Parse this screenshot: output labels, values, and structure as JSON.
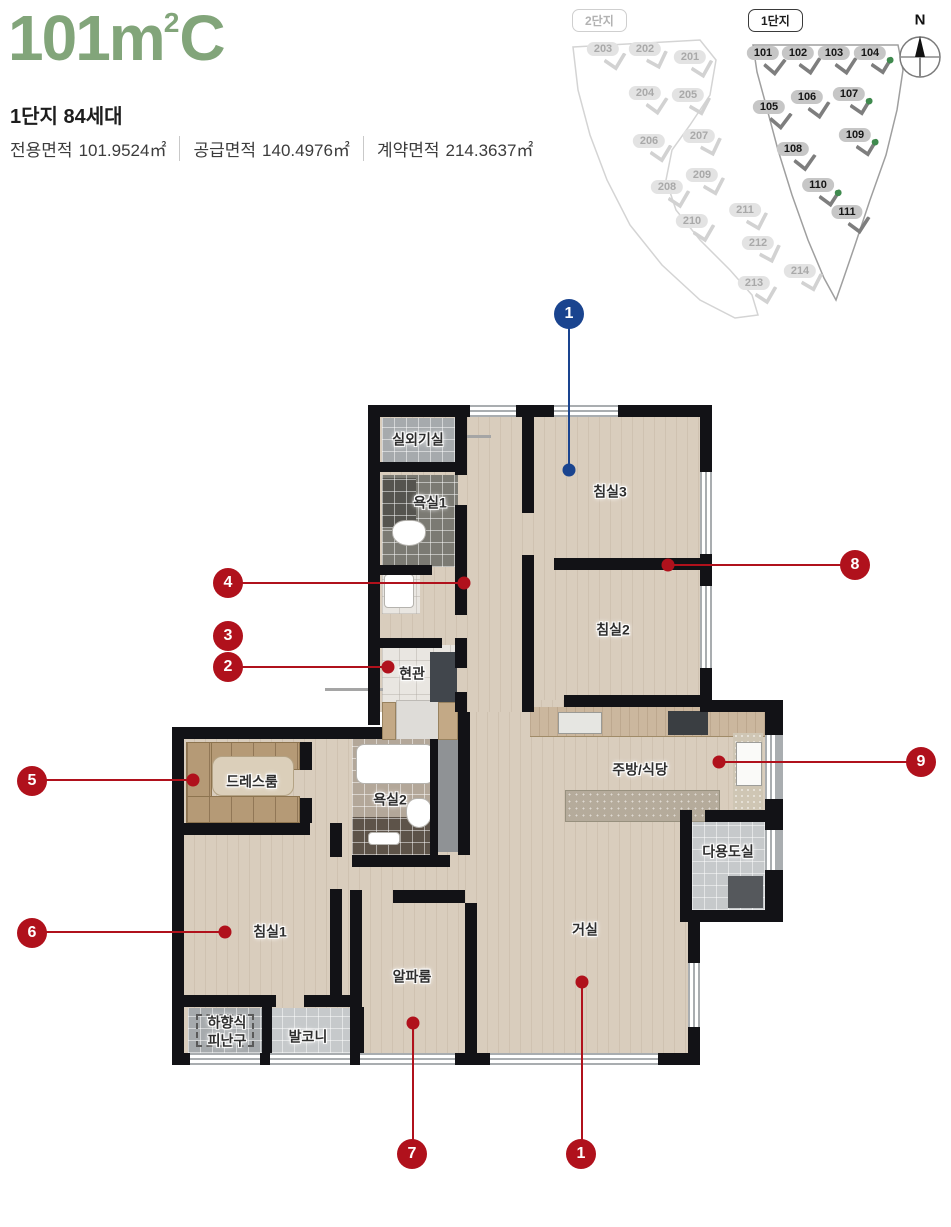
{
  "header": {
    "title_main": "101m",
    "title_sup": "2",
    "title_suffix": "C",
    "subtitle": "1단지 84세대",
    "areas": [
      {
        "label": "전용면적",
        "value": "101.9524㎡"
      },
      {
        "label": "공급면적",
        "value": "140.4976㎡"
      },
      {
        "label": "계약면적",
        "value": "214.3637㎡"
      }
    ]
  },
  "site_map": {
    "complex2_label": "2단지",
    "complex1_label": "1단지",
    "compass_label": "N",
    "complex2_buildings": [
      {
        "id": "203",
        "x": 43,
        "y": 49,
        "rot": -14
      },
      {
        "id": "202",
        "x": 85,
        "y": 49,
        "rot": -20
      },
      {
        "id": "201",
        "x": 130,
        "y": 57,
        "rot": -16
      },
      {
        "id": "204",
        "x": 85,
        "y": 93,
        "rot": -12
      },
      {
        "id": "205",
        "x": 128,
        "y": 95,
        "rot": -18
      },
      {
        "id": "206",
        "x": 89,
        "y": 141,
        "rot": -14
      },
      {
        "id": "207",
        "x": 139,
        "y": 136,
        "rot": -20
      },
      {
        "id": "208",
        "x": 107,
        "y": 187,
        "rot": -15
      },
      {
        "id": "209",
        "x": 142,
        "y": 175,
        "rot": -18
      },
      {
        "id": "210",
        "x": 132,
        "y": 221,
        "rot": -15
      },
      {
        "id": "211",
        "x": 185,
        "y": 210,
        "rot": -18
      },
      {
        "id": "212",
        "x": 198,
        "y": 243,
        "rot": -20
      },
      {
        "id": "213",
        "x": 194,
        "y": 283,
        "rot": -15
      },
      {
        "id": "214",
        "x": 240,
        "y": 271,
        "rot": -18
      }
    ],
    "complex1_buildings": [
      {
        "id": "101",
        "x": 203,
        "y": 53,
        "rot": -8,
        "green": false
      },
      {
        "id": "102",
        "x": 238,
        "y": 53,
        "rot": -12,
        "green": false
      },
      {
        "id": "103",
        "x": 274,
        "y": 53,
        "rot": -12,
        "green": false
      },
      {
        "id": "104",
        "x": 310,
        "y": 53,
        "rot": -14,
        "green": true
      },
      {
        "id": "105",
        "x": 209,
        "y": 107,
        "rot": -8,
        "green": false
      },
      {
        "id": "106",
        "x": 247,
        "y": 97,
        "rot": -12,
        "green": false
      },
      {
        "id": "107",
        "x": 289,
        "y": 94,
        "rot": -14,
        "green": true
      },
      {
        "id": "108",
        "x": 233,
        "y": 149,
        "rot": -10,
        "green": false
      },
      {
        "id": "109",
        "x": 295,
        "y": 135,
        "rot": -14,
        "green": true
      },
      {
        "id": "110",
        "x": 258,
        "y": 185,
        "rot": -12,
        "green": true
      },
      {
        "id": "111",
        "x": 287,
        "y": 212,
        "rot": -12,
        "green": false
      }
    ]
  },
  "floor_plan": {
    "rooms": [
      {
        "name": "실외기실",
        "x": 248,
        "y": 40
      },
      {
        "name": "욕실1",
        "x": 260,
        "y": 103
      },
      {
        "name": "침실3",
        "x": 440,
        "y": 92
      },
      {
        "name": "침실2",
        "x": 443,
        "y": 230
      },
      {
        "name": "현관",
        "x": 242,
        "y": 274
      },
      {
        "name": "드레스룸",
        "x": 82,
        "y": 382
      },
      {
        "name": "욕실2",
        "x": 220,
        "y": 400
      },
      {
        "name": "주방/식당",
        "x": 470,
        "y": 370
      },
      {
        "name": "다용도실",
        "x": 558,
        "y": 452
      },
      {
        "name": "침실1",
        "x": 100,
        "y": 532
      },
      {
        "name": "알파룸",
        "x": 242,
        "y": 577
      },
      {
        "name": "거실",
        "x": 415,
        "y": 530
      },
      {
        "name": "하향식\n피난구",
        "x": 57,
        "y": 632
      },
      {
        "name": "발코니",
        "x": 138,
        "y": 637
      }
    ],
    "markers": [
      {
        "label": "1",
        "color": "blue",
        "cx": 569,
        "cy": 314,
        "dx": 569,
        "dy": 470
      },
      {
        "label": "8",
        "color": "red",
        "cx": 855,
        "cy": 565,
        "dx": 668,
        "dy": 565
      },
      {
        "label": "9",
        "color": "red",
        "cx": 921,
        "cy": 762,
        "dx": 719,
        "dy": 762
      },
      {
        "label": "4",
        "color": "red",
        "cx": 228,
        "cy": 583,
        "dx": 464,
        "dy": 583
      },
      {
        "label": "3",
        "color": "red",
        "cx": 228,
        "cy": 636
      },
      {
        "label": "2",
        "color": "red",
        "cx": 228,
        "cy": 667,
        "dx": 388,
        "dy": 667
      },
      {
        "label": "5",
        "color": "red",
        "cx": 32,
        "cy": 781,
        "dx": 193,
        "dy": 780
      },
      {
        "label": "6",
        "color": "red",
        "cx": 32,
        "cy": 933,
        "dx": 225,
        "dy": 932
      },
      {
        "label": "7",
        "color": "red",
        "cx": 412,
        "cy": 1154,
        "dx": 413,
        "dy": 1023
      },
      {
        "label": "1",
        "color": "red",
        "cx": 581,
        "cy": 1154,
        "dx": 582,
        "dy": 982
      }
    ]
  },
  "colors": {
    "title_green": "#82a57a",
    "marker_red": "#b0111c",
    "marker_blue": "#1a448f",
    "wall": "#121216",
    "floor": "#d9cdbd"
  }
}
